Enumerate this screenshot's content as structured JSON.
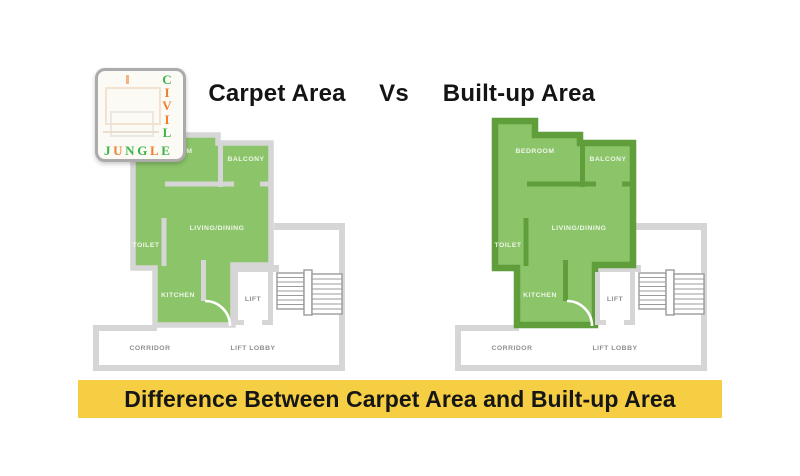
{
  "header": {
    "left_title": "Carpet Area",
    "vs": "Vs",
    "right_title": "Built-up Area"
  },
  "banner": {
    "text": "Difference Between Carpet Area and Built-up Area"
  },
  "logo": {
    "civil": [
      {
        "ch": "C",
        "color": "#3CB44A"
      },
      {
        "ch": "I",
        "color": "#EE7F2D"
      },
      {
        "ch": "V",
        "color": "#EE7F2D"
      },
      {
        "ch": "I",
        "color": "#EE7F2D"
      },
      {
        "ch": "L",
        "color": "#3CB44A"
      }
    ],
    "jungle": [
      {
        "ch": "J",
        "color": "#3CB44A"
      },
      {
        "ch": "U",
        "color": "#EE7F2D"
      },
      {
        "ch": "N",
        "color": "#3CB44A"
      },
      {
        "ch": "G",
        "color": "#3CB44A"
      },
      {
        "ch": "L",
        "color": "#EE7F2D"
      },
      {
        "ch": "E",
        "color": "#3CB44A"
      }
    ]
  },
  "floorplan": {
    "labels": {
      "bedroom": "BEDROOM",
      "balcony": "BALCONY",
      "living": "LIVING/DINING",
      "toilet": "TOILET",
      "kitchen": "KITCHEN",
      "lift": "LIFT",
      "corridor": "CORRIDOR",
      "lift_lobby": "LIFT LOBBY"
    }
  },
  "colors": {
    "room_fill": "#8CC46A",
    "carpet_wall": "#D6D6D6",
    "builtup_wall": "#5F9E3A",
    "common_wall": "#D6D6D6",
    "stairs": "#9B9B9B",
    "common_label": "#8F8F8F",
    "room_label": "rgba(255,255,255,0.85)",
    "banner_bg": "#F5CE43"
  }
}
